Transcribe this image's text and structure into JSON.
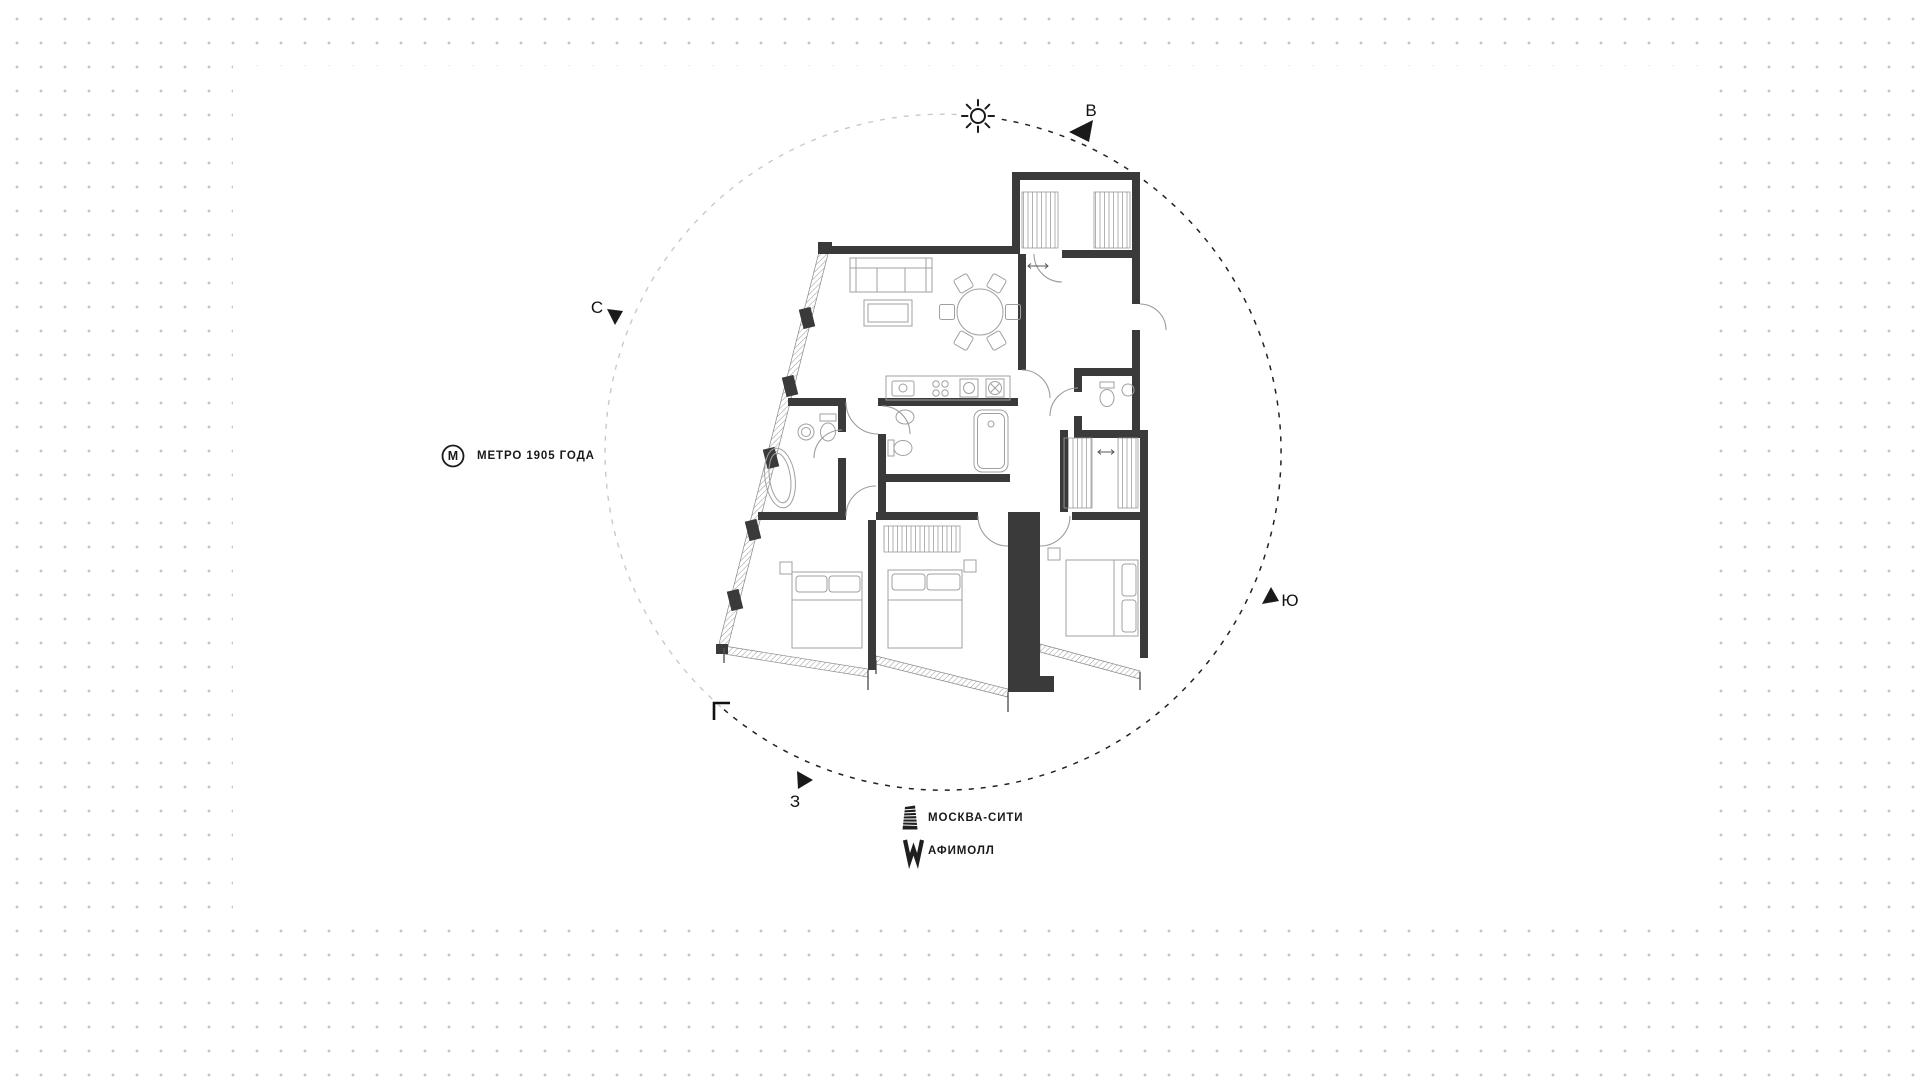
{
  "compass": {
    "north": "С",
    "east": "В",
    "south": "Ю",
    "west": "З"
  },
  "landmarks": {
    "metro": {
      "monogram": "М",
      "label": "МЕТРО 1905 ГОДА"
    },
    "moscow_city": {
      "label": "МОСКВА-СИТИ"
    },
    "afimall": {
      "label": "АФИМОЛЛ"
    }
  },
  "colors": {
    "wall": "#3a3a3a",
    "ink": "#1a1a1a",
    "thin_line": "#a0a0a0",
    "dot": "#c4c4c4",
    "arc_dark": "#222222",
    "arc_light": "#c9c9c9"
  }
}
